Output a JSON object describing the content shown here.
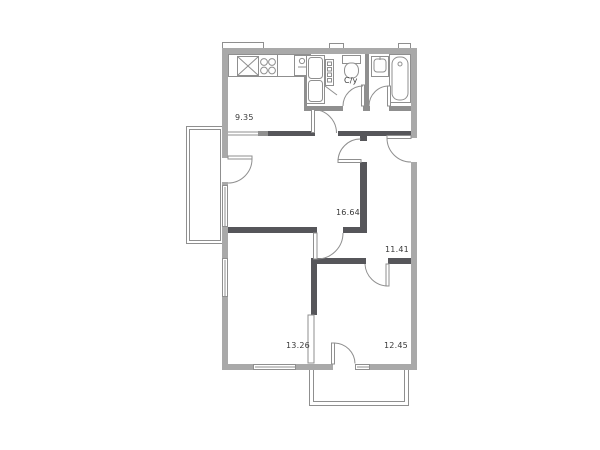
{
  "floor_plan": {
    "labels": {
      "kitchen_area": "9.35",
      "bathroom": "С/у",
      "living_area": "16.64",
      "hall_area": "11.41",
      "bedroom1_area": "13.26",
      "bedroom2_area": "12.45"
    },
    "colors": {
      "outer_wall": "#a9a9a9",
      "inner_wall": "#56565a",
      "line": "#8f8f8f",
      "text": "#3a3a3a",
      "paper": "#ffffff"
    }
  }
}
